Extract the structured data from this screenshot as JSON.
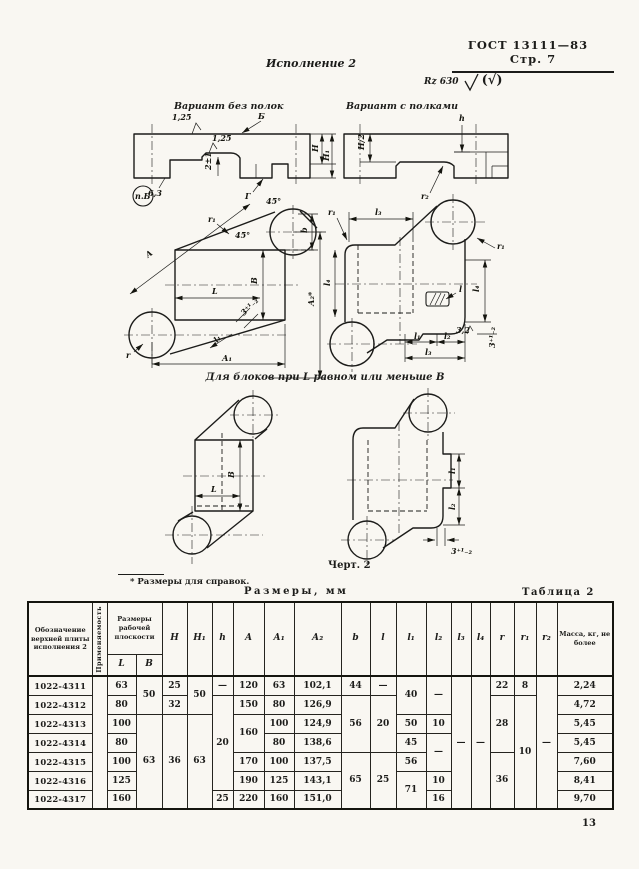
{
  "page": {
    "doc_ref": "ГОСТ 13111—83",
    "page_ref": "Стр. 7",
    "page_number": "13"
  },
  "figure": {
    "execution_title": "Исполнение 2",
    "rz_mark": "Rz 630",
    "overall_mark": "(√)",
    "variant_left": "Вариант без полок",
    "variant_right": "Вариант с полками",
    "mid_caption": "Для блоков при L равном или меньше В",
    "drawing_caption": "Черт. 2",
    "footnote": "* Размеры для справок.",
    "side_left": {
      "view_b": "Б",
      "rough_top": "1,25",
      "rough_mid": "1,25",
      "rough_left": "6,3",
      "dim_tongue": "2±1",
      "view_g": "Г",
      "detail_ref": "п.Б",
      "dim_H": "Н",
      "dim_H1": "Н₁"
    },
    "side_right": {
      "dim_h": "h",
      "dim_H2": "H/2",
      "dim_r2": "r₂"
    },
    "plan_left": {
      "dim_A": "А",
      "dim_r1": "r₁",
      "angle_top": "45°",
      "angle_mid": "45°",
      "dim_b": "b",
      "dim_B": "В",
      "dim_L": "L",
      "dim_A2": "А₂*",
      "dim_tol": "3⁺¹₋₂",
      "dim_l1": "l₁",
      "dim_r": "r",
      "dim_A1": "А₁"
    },
    "plan_right": {
      "dim_l3_top": "l₃",
      "dim_r1_left": "r₁",
      "dim_r1_right": "r₁",
      "dim_l4_left": "l₄",
      "dim_l4_right": "l₄",
      "dim_l": "l",
      "dim_l1": "l₁",
      "dim_l2": "l₂",
      "dim_l3_bot": "l₃",
      "rough_32": "3,2",
      "dim_tol": "3⁺¹₋₂"
    },
    "plan_small_left": {
      "dim_B": "В",
      "dim_L": "L"
    },
    "plan_small_right": {
      "dim_l1": "l₁",
      "dim_l2": "l₂",
      "dim_tol": "3⁺¹₋₂"
    }
  },
  "table": {
    "size_note": "Размеры, мм",
    "title": "Таблица 2",
    "headers": {
      "designation": "Обозначение верхней плиты исполнения 2",
      "applicability": "Применяемость",
      "work_plane": "Размеры рабочей плоскости",
      "L": "L",
      "B": "B",
      "H": "Н",
      "H1": "Н₁",
      "h": "h",
      "A": "А",
      "A1": "А₁",
      "A2": "А₂",
      "b": "b",
      "l": "l",
      "l1": "l₁",
      "l2": "l₂",
      "l3": "l₃",
      "l4": "l₄",
      "r": "r",
      "r1": "r₁",
      "r2": "r₂",
      "mass": "Масса, кг, не более"
    },
    "rows": [
      {
        "designation": "1022-4311",
        "L": "63",
        "B": "50",
        "H": "25",
        "H1": "50",
        "h": "—",
        "A": "120",
        "A1": "63",
        "A2": "102,1",
        "b": "44",
        "l": "—",
        "l1": "40",
        "l2": "—",
        "l3": "—",
        "l4": "—",
        "r": "22",
        "r1": "8",
        "r2": "—",
        "mass": "2,24"
      },
      {
        "designation": "1022-4312",
        "L": "80",
        "H": "32",
        "h": "20",
        "A": "150",
        "A1": "80",
        "A2": "126,9",
        "b": "56",
        "l": "20",
        "r": "28",
        "r1": "10",
        "mass": "4,72"
      },
      {
        "designation": "1022-4313",
        "L": "100",
        "B": "63",
        "H": "36",
        "H1": "63",
        "A": "160",
        "A1": "100",
        "A2": "124,9",
        "l1": "50",
        "l2": "10",
        "mass": "5,45"
      },
      {
        "designation": "1022-4314",
        "L": "80",
        "A1": "80",
        "A2": "138,6",
        "l1": "45",
        "l2": "—",
        "mass": "5,45"
      },
      {
        "designation": "1022-4315",
        "L": "100",
        "A": "170",
        "A1": "100",
        "A2": "137,5",
        "b": "65",
        "l": "25",
        "l1": "56",
        "r": "36",
        "mass": "7,60"
      },
      {
        "designation": "1022-4316",
        "L": "125",
        "A": "190",
        "A1": "125",
        "A2": "143,1",
        "l1": "71",
        "l2": "10",
        "mass": "8,41"
      },
      {
        "designation": "1022-4317",
        "L": "160",
        "h": "25",
        "A": "220",
        "A1": "160",
        "A2": "151,0",
        "l2": "16",
        "mass": "9,70"
      }
    ]
  }
}
